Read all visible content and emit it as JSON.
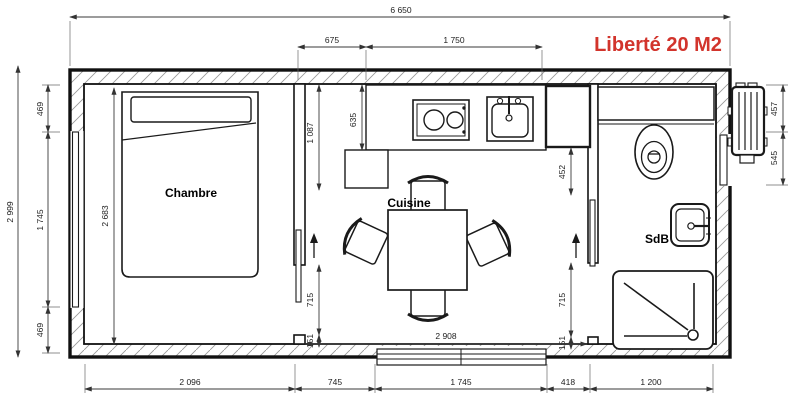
{
  "title": {
    "text": "Liberté 20 M2"
  },
  "colors": {
    "accent": "#d2342c"
  },
  "rooms": {
    "bedroom": "Chambre",
    "kitchen": "Cuisine",
    "bathroom": "SdB"
  },
  "dimensions": {
    "total_width": "6 650",
    "total_height": "2 999",
    "top_kitchen_offset": "675",
    "top_counter_width": "1 750",
    "left_wall_top": "469",
    "left_window": "1 745",
    "left_wall_bottom": "469",
    "bedroom_inner_height": "2 683",
    "counter_return_depth": "1 087",
    "counter_depth": "635",
    "bath_wall_top_offset": "452",
    "bedroom_door_opening": "715",
    "bedroom_door_offset": "151",
    "bath_door_opening": "715",
    "bath_door_offset": "151",
    "kitchen_inner_width": "2 908",
    "bottom_bedroom_width": "2 096",
    "bottom_partition": "745",
    "bottom_window_width": "1 745",
    "bottom_wall_segment": "418",
    "bottom_bathroom_width": "1 200",
    "heater_height": "457",
    "heater_offset": "545"
  }
}
